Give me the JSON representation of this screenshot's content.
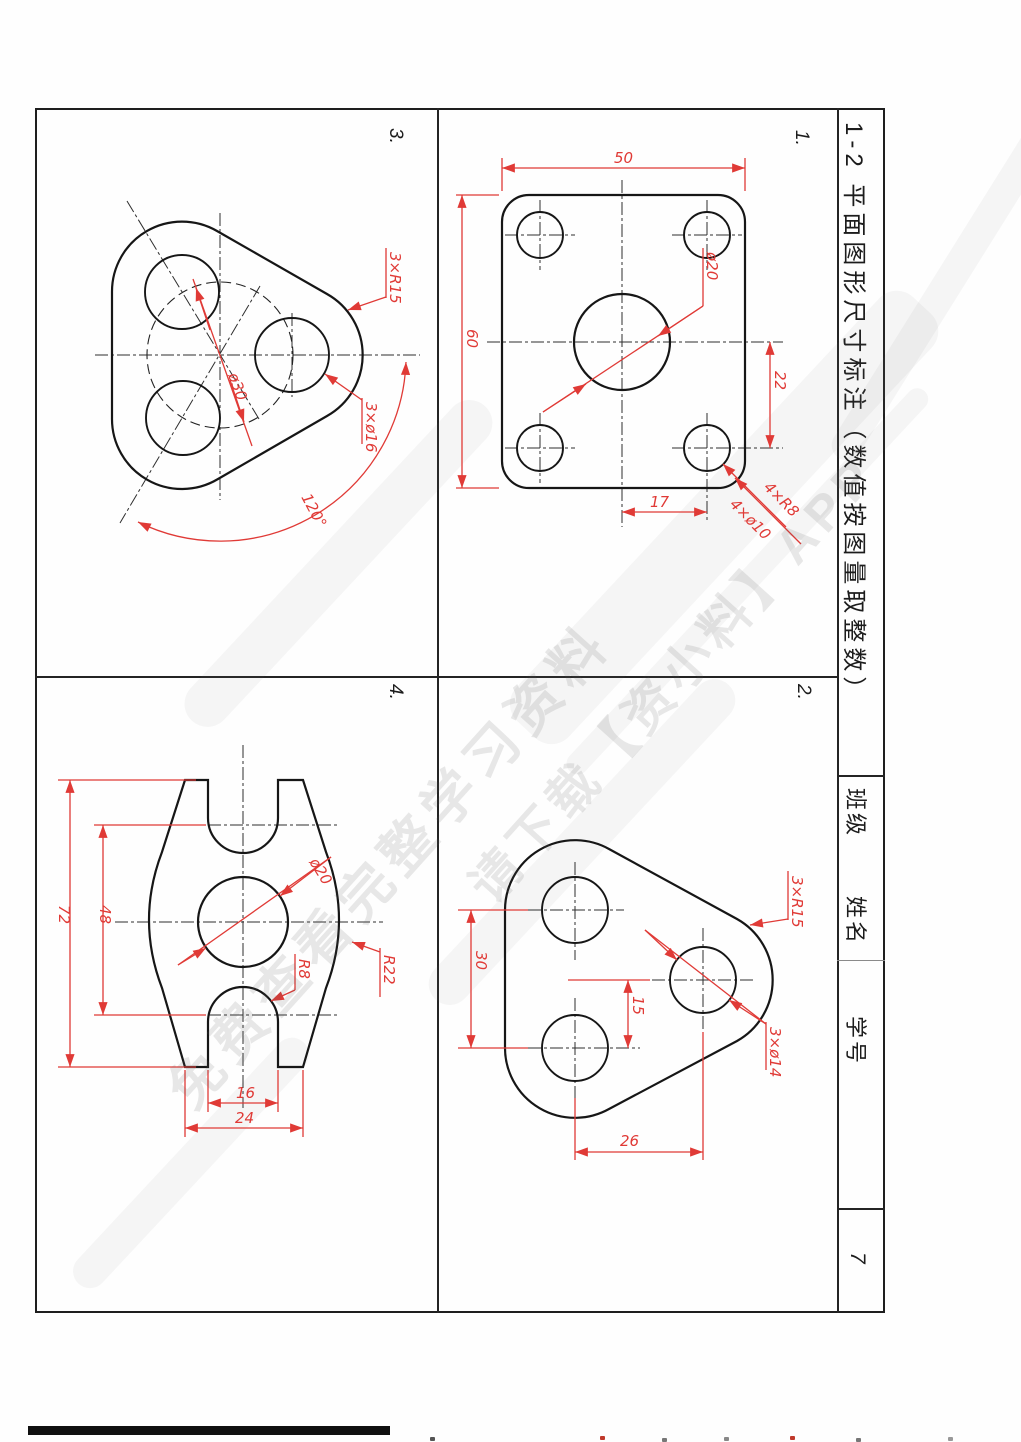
{
  "sheet": {
    "title": "1-2 平面图形尺寸标注（数值按图量取整数）",
    "page_number": "7",
    "class_label": "班级",
    "name_label": "姓名",
    "student_label": "学号"
  },
  "watermark": {
    "line1": "免费查看完整学习资料",
    "line2": "请下载【资小料】APP"
  },
  "colors": {
    "dimension_red": "#e03a36",
    "line_black": "#161616"
  },
  "drawings": {
    "d1": {
      "label": "1.",
      "dim_width": "50",
      "dim_height": "60",
      "dim_hole": "ø20",
      "dim_offset_v": "22",
      "dim_offset_h": "17",
      "dim_corner_radius": "4×R8",
      "dim_corner_holes": "4×ø10"
    },
    "d2": {
      "label": "2.",
      "dim_span": "30",
      "dim_offset": "15",
      "dim_base": "26",
      "dim_vertex": "3×R15",
      "dim_holes": "3×ø14"
    },
    "d3": {
      "label": "3.",
      "dim_vertex": "3×R15",
      "dim_holes": "3×ø16",
      "dim_bolt": "ø30",
      "dim_angle": "120°"
    },
    "d4": {
      "label": "4.",
      "dim_overall": "72",
      "dim_centers": "48",
      "dim_hole": "ø20",
      "dim_side": "R22",
      "dim_slot": "R8",
      "dim_slot_w": "16",
      "dim_base": "24"
    }
  }
}
